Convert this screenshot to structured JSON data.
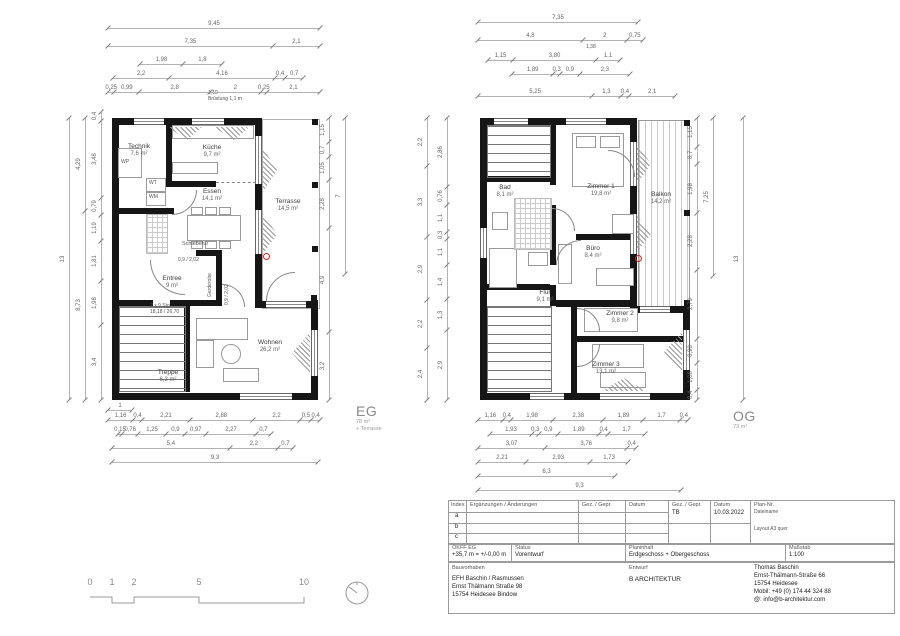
{
  "floors": {
    "eg": {
      "label": "EG",
      "area": "78 m²",
      "note": "+ Terrasse"
    },
    "og": {
      "label": "OG",
      "area": "73 m²"
    }
  },
  "eg": {
    "rooms": [
      {
        "name": "Technik",
        "area": "7,6 m²"
      },
      {
        "name": "Küche",
        "area": "9,7 m²"
      },
      {
        "name": "Essen",
        "area": "14,1 m²"
      },
      {
        "name": "Terrasse",
        "area": "14,5 m²"
      },
      {
        "name": "Entree",
        "area": "9 m²"
      },
      {
        "name": "Treppe",
        "area": "6,3 m²"
      },
      {
        "name": "Wohnen",
        "area": "26,2 m²"
      }
    ],
    "labels": {
      "wp": "WP",
      "wt": "WT",
      "wm": "WM",
      "schiebetuer": "Schiebetür",
      "door_note": "0,9 / 2,02",
      "door_note_v": "0,9 / 2,02",
      "garderobe": "Garderobe",
      "stairs1": "2 x 9 Stg.",
      "stairs2": "18,18 / 26,70",
      "bruestung1": "1,10",
      "bruestung2": "Brüstung 1,1 m"
    },
    "dims": {
      "t1": [
        "9,45"
      ],
      "t2": [
        "7,35",
        "2,1"
      ],
      "t3": [
        "1,98",
        "1,8"
      ],
      "t4": [
        "2,2",
        "4,16",
        "0,4",
        "0,7"
      ],
      "t5": [
        "0,25",
        "0,99",
        "2,8",
        "2",
        "0,25",
        "2,1"
      ],
      "l1": [
        "13"
      ],
      "l2": [
        "4,29",
        "8,73"
      ],
      "l3": [
        "0,4",
        "3,48",
        "0,79",
        "1,19",
        "1,81",
        "1,98",
        "3,4"
      ],
      "r1": [
        "1,15",
        "0,7",
        "1,05",
        "2,28",
        "4,9",
        "3,2"
      ],
      "r2": [
        "7"
      ],
      "b0": [
        "1"
      ],
      "b1": [
        "1,16",
        "0,4",
        "2,21",
        "2,88",
        "2,2",
        "0,5",
        "0,4"
      ],
      "b2": [
        "0,15",
        "0,76",
        "1,25",
        "0,9",
        "0,97",
        "2,27",
        "0,7"
      ],
      "b3": [
        "5,4",
        "2,2",
        "0,7"
      ],
      "b4": [
        "9,3"
      ]
    }
  },
  "og": {
    "rooms": [
      {
        "name": "Bad",
        "area": "8,1 m²"
      },
      {
        "name": "Zimmer 1",
        "area": "19,8 m²"
      },
      {
        "name": "Balkon",
        "area": "14,2 m²"
      },
      {
        "name": "Büro",
        "area": "8,4 m²"
      },
      {
        "name": "Flur",
        "area": "9,1 m²"
      },
      {
        "name": "Zimmer 2",
        "area": "9,8 m²"
      },
      {
        "name": "Zimmer 3",
        "area": "13,1 m²"
      }
    ],
    "labels": {
      "note138": "1,38"
    },
    "dims": {
      "t1": [
        "7,35"
      ],
      "t2": [
        "4,8",
        "2",
        "0,75"
      ],
      "t3": [
        "1,15",
        "3,80",
        "1,1"
      ],
      "t4": [
        "1,89",
        "0,3",
        "0,9",
        "2,3"
      ],
      "t5": [
        "5,25",
        "1,3",
        "0,4",
        "2,1"
      ],
      "l1": [
        "2,2",
        "3,3",
        "2,9",
        "2,2",
        "2,4"
      ],
      "l2": [
        "2,86",
        "0,76",
        "1,1",
        "0,3",
        "1,1",
        "1,4",
        "1,3",
        "2,9"
      ],
      "r1": [
        "1,15",
        "0,7",
        "1,98",
        "2,28",
        "2,79",
        "0,98",
        "1,08",
        "0,4"
      ],
      "r2": [
        "7,25"
      ],
      "r3": [
        "13"
      ],
      "b1": [
        "1,16",
        "0,4",
        "1,98",
        "2,38",
        "1,89",
        "1,7",
        "0,4"
      ],
      "b2": [
        "1,93",
        "0,3",
        "0,9",
        "1,89",
        "0,4",
        "1,7"
      ],
      "b3": [
        "3,07",
        "3,76",
        "0,4"
      ],
      "b4": [
        "2,21",
        "2,93",
        "1,73"
      ],
      "b5": [
        "6,3"
      ],
      "b6": [
        "9,3"
      ]
    }
  },
  "titleblock": {
    "revisions": {
      "index_label": "Index",
      "changes_label": "Ergänzungen / Änderungen",
      "drawn_label": "Gez. / Gepr.",
      "date_label": "Datum",
      "drawn2_label": "Gez. / Gepr.",
      "drawn2_value": "TB",
      "date2_label": "Datum",
      "date2_value": "10.03.2022",
      "plan_no_label": "Plan-Nr.",
      "plan_no_value": "Dateiname",
      "layout_note": "Layout A3 quer",
      "rows": [
        "a",
        "b",
        "c"
      ]
    },
    "level": {
      "label": "OKFF EG",
      "value": "+35,7 m = +/-0,00 m"
    },
    "status": {
      "label": "Status",
      "value": "Vorentwurf"
    },
    "content": {
      "label": "Planinhalt",
      "value": "Erdgeschoss + Obergeschoss"
    },
    "scale": {
      "label": "Maßstab",
      "value": "1:100"
    },
    "project": {
      "label": "Bauvorhaben",
      "lines": [
        "EFH Baschin / Rasmussen",
        "Ernst Thälmann Straße 98",
        "15754 Heidesee Bindow"
      ]
    },
    "design": {
      "label": "Entwurf",
      "value": "B ARCHITEKTUR"
    },
    "architect": {
      "lines": [
        "Thomas Baschin",
        "Ernst-Thälmann-Straße 66",
        "15754 Heidesee",
        "Mobil: +49 (0) 174 44 324 88",
        "@: info@b-architektur.com"
      ]
    }
  },
  "scalebar": {
    "ticks": [
      "0",
      "1",
      "2",
      "5",
      "10"
    ]
  }
}
